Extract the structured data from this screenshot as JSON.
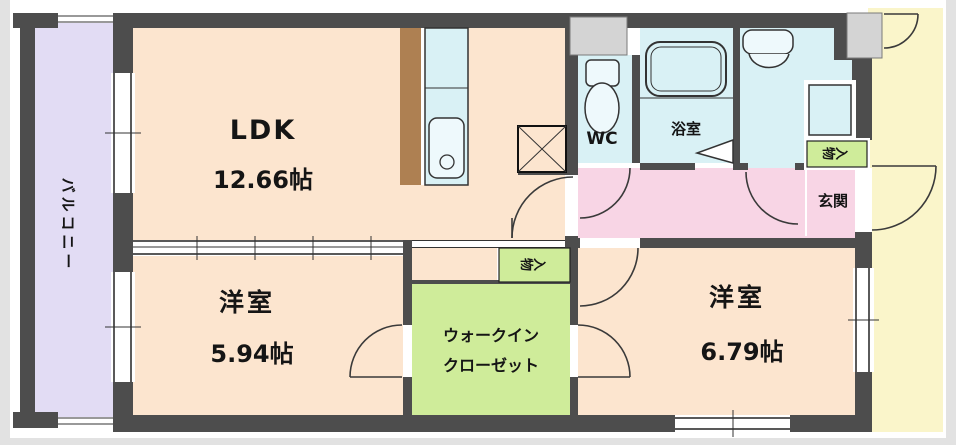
{
  "floorplan": {
    "rooms": {
      "balcony": {
        "label": "バルコニー"
      },
      "ldk": {
        "label": "LDK",
        "size": "12.66帖"
      },
      "bedroom_left": {
        "label": "洋室",
        "size": "5.94帖"
      },
      "bedroom_right": {
        "label": "洋室",
        "size": "6.79帖"
      },
      "walk_in_closet": {
        "label_line1": "ウォークイン",
        "label_line2": "クローゼット"
      },
      "toilet": {
        "label": "WC"
      },
      "bathroom": {
        "label": "浴室"
      },
      "entrance": {
        "label": "玄関"
      },
      "storage_hall": {
        "label": "物入"
      },
      "storage_center": {
        "label": "物入"
      }
    },
    "colors": {
      "wall": "#4d4d4d",
      "room-peach": "#fce5cf",
      "balcony-purple": "#e2dcf4",
      "water-blue": "#d9f1f5",
      "hallway-pink": "#f8d5e5",
      "closet-green": "#cfec9a",
      "corridor-yellow": "#faf5ca",
      "kitchen-brown": "#ae8052",
      "shaft-gray": "#d4d4d4"
    }
  }
}
